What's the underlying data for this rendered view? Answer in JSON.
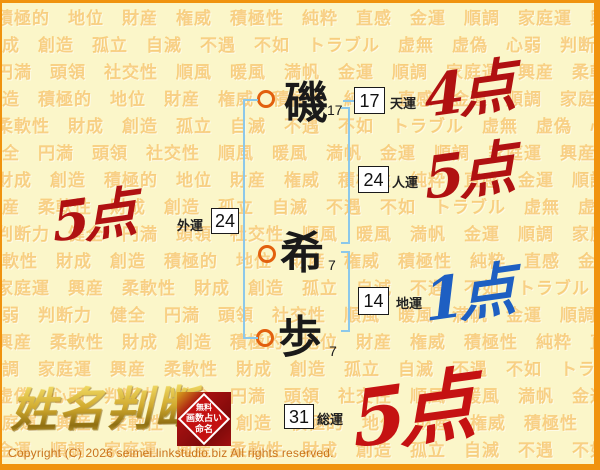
{
  "background": {
    "color": "#FBF6C9",
    "border_color": "#F0930E",
    "watermark_color": "#F2A226",
    "words": [
      "積極的",
      "地位",
      "財産",
      "権威",
      "積極性",
      "純粋",
      "直感",
      "金運",
      "順調",
      "家庭運",
      "興産",
      "柔軟性",
      "財成",
      "創造",
      "孤立",
      "自滅",
      "不遇",
      "不如",
      "トラブル",
      "虚無",
      "虚偽",
      "心弱",
      "判断力",
      "健全",
      "円満",
      "頭領",
      "社交性",
      "順風",
      "暖風",
      "満帆",
      "金運",
      "順調",
      "家庭運",
      "興産",
      "柔軟性",
      "財成",
      "創造"
    ]
  },
  "name": {
    "characters": [
      {
        "char": "磯",
        "strokes": "17"
      },
      {
        "char": "希",
        "strokes": "7"
      },
      {
        "char": "歩",
        "strokes": "7"
      }
    ]
  },
  "fortunes": {
    "tenun": {
      "label": "天運",
      "value": "17",
      "score": "4点",
      "score_color": "#B01111"
    },
    "jinun": {
      "label": "人運",
      "value": "24",
      "score": "5点",
      "score_color": "#B01111"
    },
    "gaiun": {
      "label": "外運",
      "value": "24",
      "score": "5点",
      "score_color": "#B01111"
    },
    "chiun": {
      "label": "地運",
      "value": "14",
      "score": "1点",
      "score_color": "#1E5FC2"
    },
    "souun": {
      "label": "総運",
      "value": "31",
      "score": "5点",
      "score_color": "#C51212"
    }
  },
  "diagram": {
    "bracket_color": "#8CC8EA",
    "circle_color": "#E2600E"
  },
  "logo": {
    "text": "姓名判断",
    "stamp": [
      "無料",
      "画数占い",
      "命名"
    ]
  },
  "footer": {
    "copyright": "Copyright (C) 2026 seimei.linkstudio.biz All rights reserved."
  }
}
